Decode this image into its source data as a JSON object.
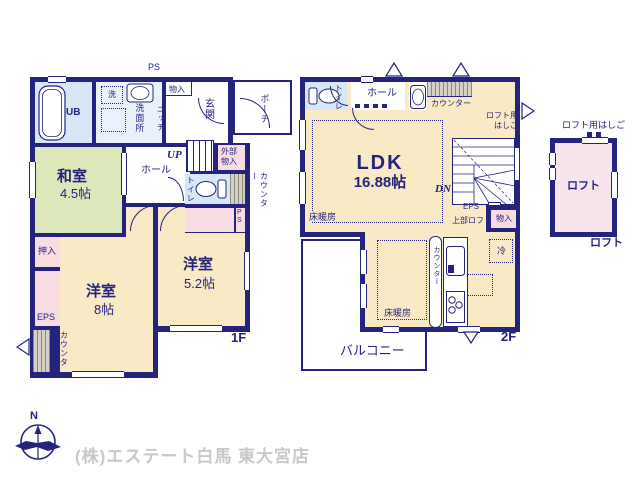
{
  "compass": {
    "north_label": "N"
  },
  "footer": {
    "company_text": "(株)エステート白馬 東大宮店"
  },
  "colors": {
    "wall_navy": "#24247e",
    "room_cream": "#f9e9c4",
    "tatami_green": "#dce8ba",
    "bath_blue": "#d6e7f7",
    "closet_pink": "#f8dce2",
    "loft_pink": "#f7e4ec",
    "footer_gray": "#c8c8c8"
  },
  "floor1": {
    "caption": "1F",
    "labels": {
      "ps_top": "PS",
      "monoire_top": "物入",
      "ub": "UB",
      "washer": "洗",
      "senmenjo": "洗面所",
      "niche": "ニッチ",
      "genkan": "玄関",
      "porch": "ポーチ",
      "hall": "ホール",
      "up": "UP",
      "gaibu_monoire": "外部物入",
      "toilet": "トイレ",
      "counter_right": "カウンター",
      "ps_right": "PS",
      "washitsu": "和室",
      "washitsu_size": "4.5帖",
      "oshiire": "押入",
      "eps": "EPS",
      "counter_left": "カウンター",
      "yoshitsu8": "洋室",
      "yoshitsu8_size": "8帖",
      "yoshitsu52": "洋室",
      "yoshitsu52_size": "5.2帖"
    }
  },
  "floor2": {
    "caption": "2F",
    "labels": {
      "toilet": "トイレ",
      "hall": "ホール",
      "counter_top": "カウンター",
      "loft_ladder_line1": "ロフト用",
      "loft_ladder_line2": "はしご",
      "ldk": "LDK",
      "ldk_size": "16.88帖",
      "dn": "DN",
      "eps": "EPS",
      "upper_loft": "上部ロフト",
      "monoire": "物入",
      "fridge": "冷",
      "counter_kitchen": "カウンター",
      "floor_heating_1": "床暖房",
      "floor_heating_2": "床暖房",
      "balcony": "バルコニー"
    }
  },
  "loft": {
    "ladder_label": "ロフト用はしご",
    "room_label": "ロフト",
    "caption": "ロフト"
  }
}
